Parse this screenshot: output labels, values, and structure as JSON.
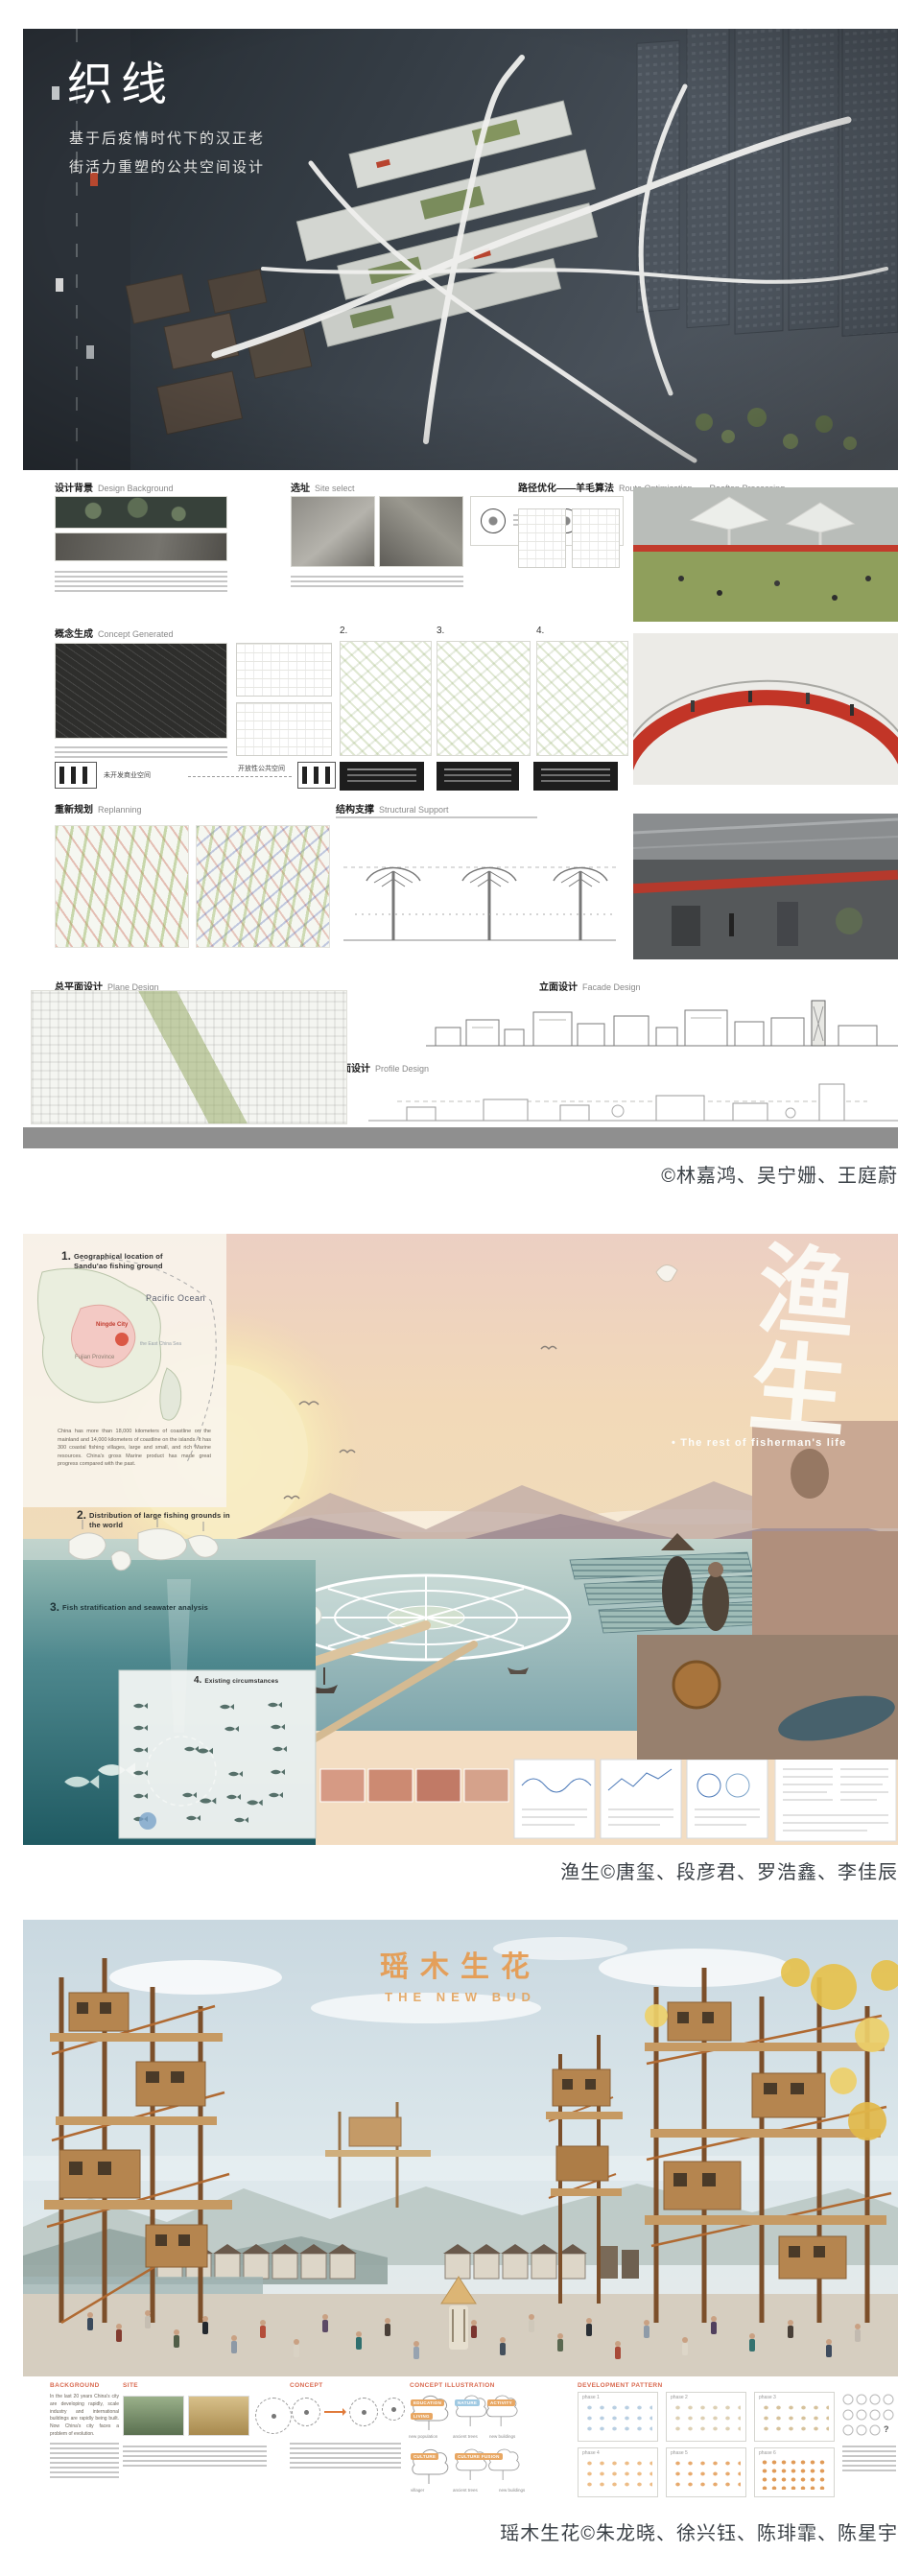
{
  "colors": {
    "caption_text": "#3a4046",
    "poster1_accent_red": "#c0392b",
    "poster3_title_orange": "#e69a4f",
    "poster3_section_header": "#d96a50",
    "poster3_nature_blue": "#9fc9e2"
  },
  "captions": {
    "poster1": "©林嘉鸿、吴宁姗、王庭蔚",
    "poster2": "渔生©唐玺、段彦君、罗浩鑫、李佳辰",
    "poster3": "瑶木生花©朱龙晓、徐兴钰、陈琲霏、陈星宇"
  },
  "poster1": {
    "title": "织线",
    "subtitle_line1": "基于后疫情时代下的汉正老",
    "subtitle_line2": "街活力重塑的公共空间设计",
    "headers": {
      "design_background_zh": "设计背景",
      "design_background_en": "Design Background",
      "site_select_zh": "选址",
      "site_select_en": "Site select",
      "route_zh": "路径优化——羊毛算法",
      "route_en": "Route Optimization——Rooftop Processing",
      "concept_zh": "概念生成",
      "concept_en": "Concept Generated",
      "replanning_zh": "重新规划",
      "replanning_en": "Replanning",
      "structure_zh": "结构支撑",
      "structure_en": "Structural Support",
      "plane_zh": "总平面设计",
      "plane_en": "Plane Design",
      "facade_zh": "立面设计",
      "facade_en": "Facade Design",
      "profile_zh": "剖面设计",
      "profile_en": "Profile Design"
    },
    "numbers": {
      "n1": "1.",
      "n2": "2.",
      "n3": "3.",
      "n4": "4."
    },
    "labels": {
      "undeveloped_commercial": "未开发商业空间",
      "open_public_space": "开放性公共空间"
    }
  },
  "poster2": {
    "title": "渔生",
    "tagline": "• The rest of fisherman's life",
    "sec1_num": "1.",
    "sec1_title": "Geographical location of Sandu'ao fishing ground",
    "sec2_num": "2.",
    "sec2_title": "Distribution of large fishing grounds in the world",
    "sec3_num": "3.",
    "sec3_title": "Fish stratification and seawater analysis",
    "sec4_num": "4.",
    "sec4_title": "Existing circumstances",
    "map_labels": {
      "pacific": "Pacific Ocean",
      "city": "Ningde City",
      "province": "Fujian Province",
      "sea": "the East China Sea"
    },
    "intro_text": "China has more than 18,000 kilometers of coastline on the mainland and 14,000 kilometers of coastline on the islands. It has 300 coastal fishing villages, large and small, and rich Marine resources. China's gross Marine product has made great progress compared with the past."
  },
  "poster3": {
    "title": "瑶木生花",
    "subtitle": "THE NEW BUD",
    "col_background": "BACKGROUND",
    "col_site": "SITE",
    "col_concept": "CONCEPT",
    "col_concept_illustration": "CONCEPT ILLUSTRATION",
    "col_development": "DEVELOPMENT PATTERN",
    "background_text": "In the last 20 years China's city are developing rapidly, scale industry and international buildings are rapidly being built. Now China's city faces a problem of evolution.",
    "tree_labels": {
      "education": "EDUCATION",
      "living": "LIVING",
      "nature": "NATURE",
      "activity": "ACTIVITY",
      "culture": "CULTURE",
      "culture_fusion": "CULTURE FUSION"
    },
    "tree_sublabels": {
      "ancient_trees": "ancient trees",
      "new_buildings": "new buildings",
      "new_population": "new population",
      "villager": "villager"
    },
    "phases": [
      "phase 1",
      "phase 2",
      "phase 3",
      "phase 4",
      "phase 5",
      "phase 6"
    ],
    "legend_question": "?"
  }
}
